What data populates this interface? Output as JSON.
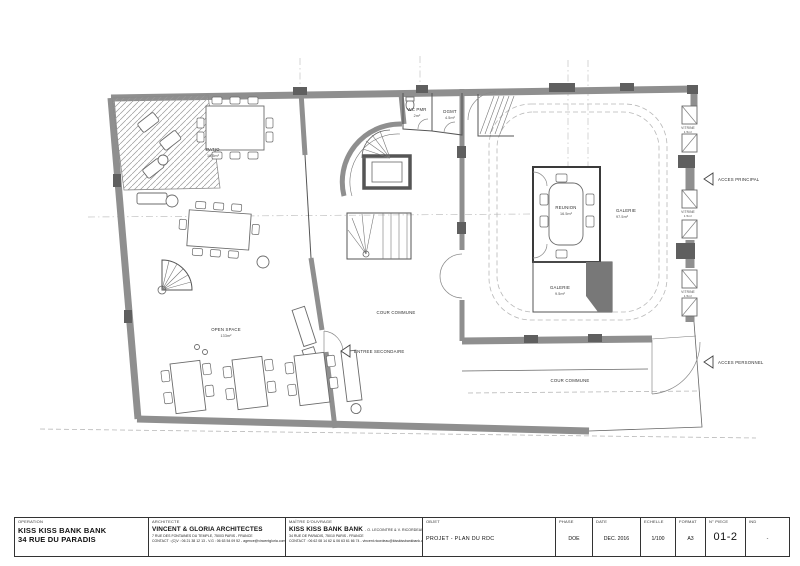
{
  "palette": {
    "wall_gray": "#8f8f8f",
    "pillar_gray": "#5f5f5f",
    "line_dark": "#555555",
    "paper": "#ffffff"
  },
  "plan": {
    "rooms": {
      "patio": {
        "name": "PATIO",
        "area": "16.5m²"
      },
      "open_space": {
        "name": "OPEN SPACE",
        "area": "133m²"
      },
      "wc_pmr": {
        "name": "WC PMR",
        "area": "2m²"
      },
      "dgmt": {
        "name": "DGMT",
        "area": "4.5m²"
      },
      "reunion": {
        "name": "REUNION",
        "area": "16.5m²"
      },
      "galerie": {
        "name": "GALERIE",
        "area": "97.5m²"
      },
      "galerie_small": {
        "name": "GALERIE",
        "area": "9.5m²"
      },
      "vitrine": {
        "name": "VITRINE",
        "area": "1.5m²"
      }
    },
    "annotations": {
      "cour_commune_center": "COUR COMMUNE",
      "cour_commune_bottom": "COUR COMMUNE",
      "acces_principal": "ACCES PRINCIPAL",
      "acces_personnel": "ACCES PERSONNEL",
      "entree_secondaire": "ENTREE SECONDAIRE"
    }
  },
  "titleblock": {
    "operation": {
      "header": "OPERATION",
      "line1": "KISS KISS BANK BANK",
      "line2": "34 RUE DU PARADIS"
    },
    "architecte": {
      "header": "ARCHITECTE",
      "name": "VINCENT & GLORIA ARCHITECTES",
      "address": "7 RUE DES FONTAINES DU TEMPLE, 75003 PARIS - FRANCE",
      "contact": "CONTACT : (C)V : 06 21 38 12 13 - V.G : 06 63 54 09 52 - agence@vincentgloria.com"
    },
    "maitre_ouvrage": {
      "header": "MAÎTRE D'OUVRAGE",
      "name": "KISS KISS BANK BANK",
      "sub": "- O. LECOINTRE & V. RICORDEAU",
      "address": "34 RUE DE PARADIS, 75010 PARIS - FRANCE",
      "contact": "CONTACT : 06 62 08 14 62 & 06 63 61 66 74 - vincent.ricordeau@kisskissbankbank.com"
    },
    "objet": {
      "header": "OBJET",
      "value": "PROJET - PLAN DU RDC"
    },
    "phase": {
      "header": "PHASE",
      "value": "DOE"
    },
    "date": {
      "header": "DATE",
      "value": "DEC. 2016"
    },
    "echelle": {
      "header": "ECHELLE",
      "value": "1/100"
    },
    "format": {
      "header": "FORMAT",
      "value": "A3"
    },
    "piece": {
      "header": "N° PIECE",
      "value": "01-2"
    },
    "ind": {
      "header": "IND",
      "value": "-"
    }
  }
}
